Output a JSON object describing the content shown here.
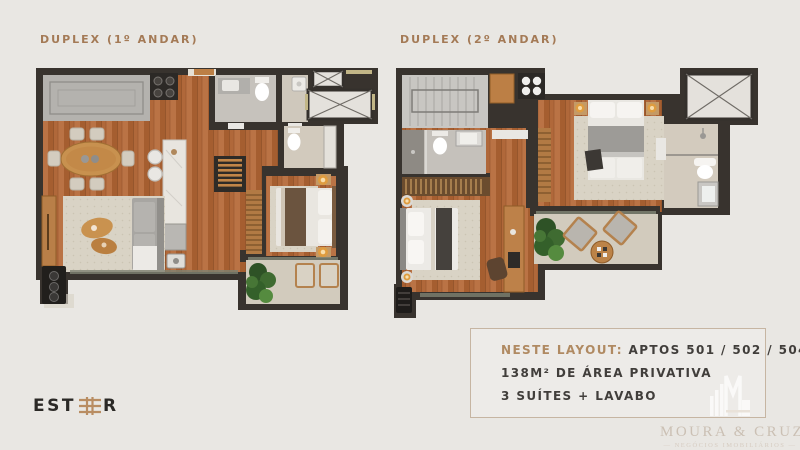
{
  "plans": [
    {
      "id": "first-floor",
      "label": "DUPLEX (1º ANDAR)"
    },
    {
      "id": "second-floor",
      "label": "DUPLEX (2º ANDAR)"
    }
  ],
  "info_box": {
    "highlight": "NESTE LAYOUT:",
    "apartments": "APTOS 501 / 502 / 504 / 505",
    "area": "138M² DE ÁREA PRIVATIVA",
    "rooms": "3 SUÍTES + LAVABO"
  },
  "branding": {
    "logo_prefix": "EST",
    "logo_suffix": "R",
    "logo_full_name": "ESTHER"
  },
  "watermark": {
    "name": "MOURA & CRUZ",
    "tagline": "— NEGÓCIOS IMOBILIÁRIOS —"
  },
  "colors": {
    "background": "#e9e7e3",
    "wall": "#38332e",
    "wood_floor": "#b0683a",
    "accent_tan": "#b08a62",
    "title_text": "#a47a56",
    "info_text": "#413e3b",
    "info_border": "#c6b5a2",
    "watermark": "#cbc0b4"
  }
}
